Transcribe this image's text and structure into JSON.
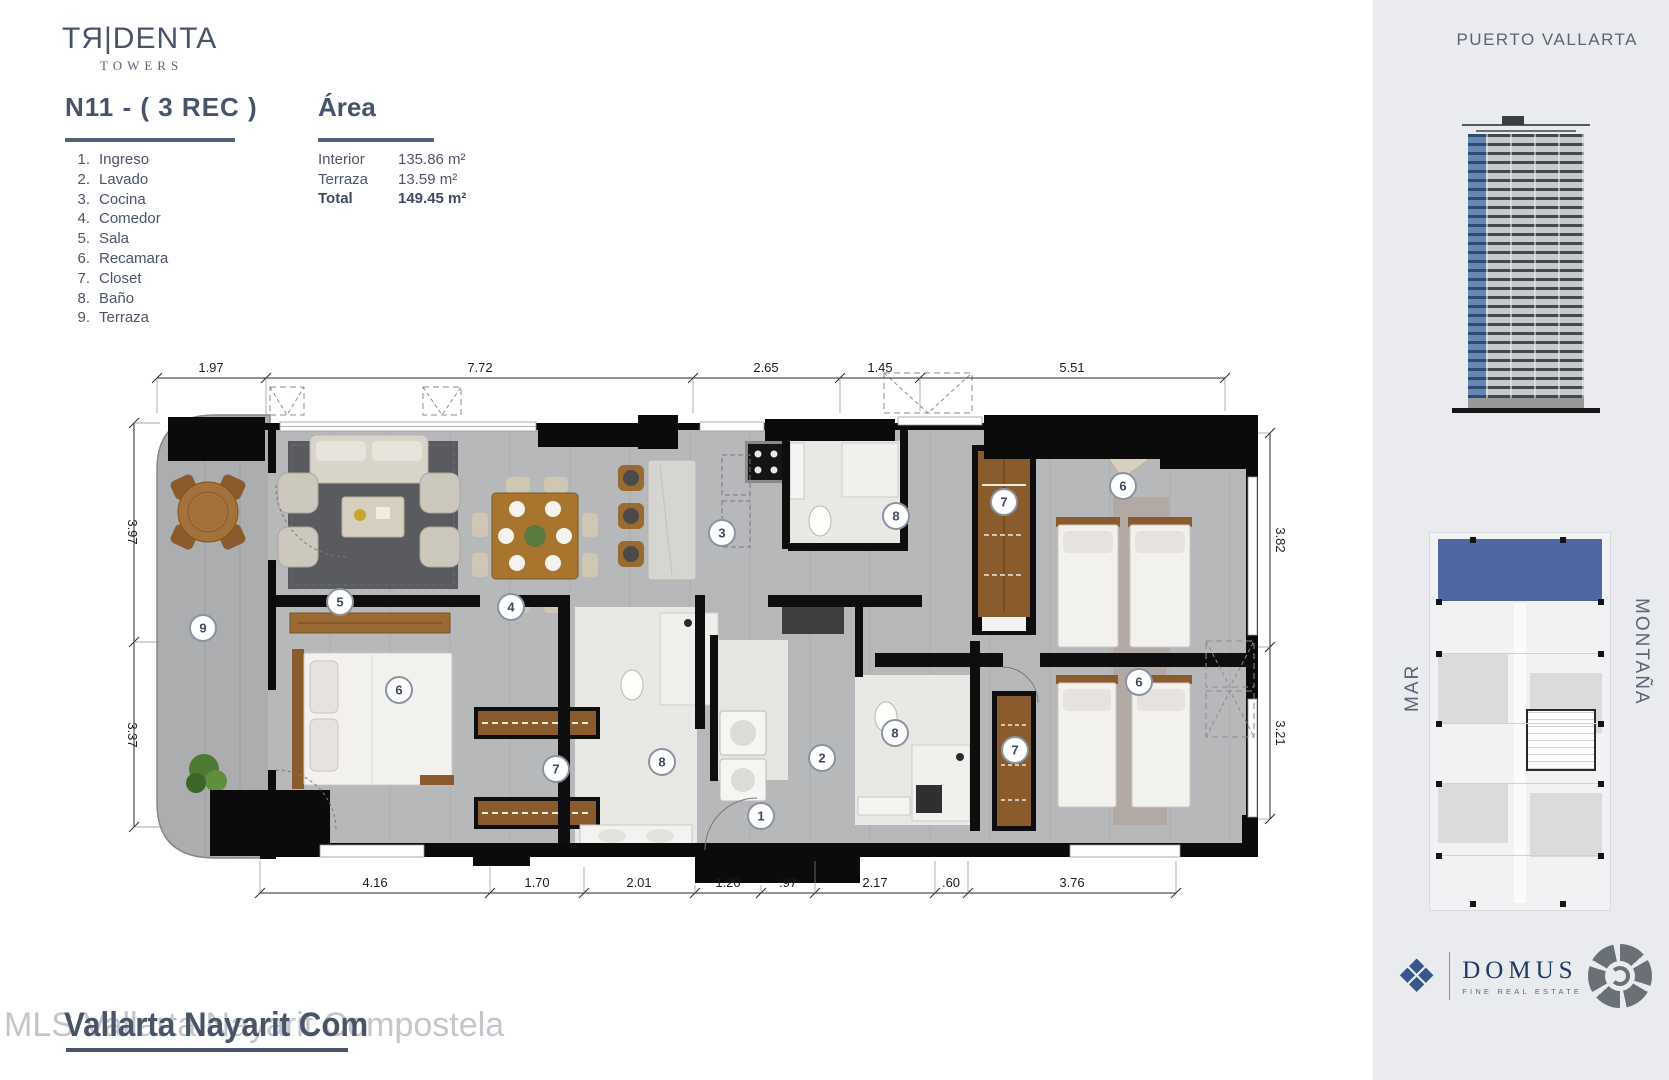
{
  "brand": {
    "name": "TЯ|DENTA",
    "sub": "TOWERS"
  },
  "sidebar": {
    "location": "PUERTO VALLARTA",
    "left_label": "MAR",
    "right_label": "MONTAÑA"
  },
  "unit": {
    "title": "N11 - ( 3 REC )"
  },
  "legend": {
    "items": [
      {
        "num": "1.",
        "label": "Ingreso"
      },
      {
        "num": "2.",
        "label": "Lavado"
      },
      {
        "num": "3.",
        "label": "Cocina"
      },
      {
        "num": "4.",
        "label": "Comedor"
      },
      {
        "num": "5.",
        "label": "Sala"
      },
      {
        "num": "6.",
        "label": "Recamara"
      },
      {
        "num": "7.",
        "label": "Closet"
      },
      {
        "num": "8.",
        "label": "Baño"
      },
      {
        "num": "9.",
        "label": "Terraza"
      }
    ]
  },
  "area": {
    "title": "Área",
    "rows": [
      {
        "label": "Interior",
        "value": "135.86 m²"
      },
      {
        "label": "Terraza",
        "value": "13.59 m²"
      },
      {
        "label": "Total",
        "value": "149.45 m²"
      }
    ]
  },
  "plan": {
    "dims_top": [
      "1.97",
      "7.72",
      "2.65",
      "1.45",
      "5.51"
    ],
    "dims_bottom": [
      "4.16",
      "1.70",
      "2.01",
      "1.20",
      ".97",
      "2.17",
      ".60",
      "3.76"
    ],
    "dims_left": [
      "3.97",
      "3.37"
    ],
    "dims_right": [
      "3.82",
      "3.21"
    ],
    "markers": [
      "1",
      "2",
      "3",
      "4",
      "5",
      "6",
      "6",
      "6",
      "7",
      "7",
      "7",
      "8",
      "8",
      "8",
      "9"
    ]
  },
  "footer": {
    "watermark_back": "MLS Vallarta Nayarit Compostela",
    "watermark_front": "Vallarta Nayarit Com",
    "brokerage": "DOMUS",
    "brokerage_tagline": "FINE REAL ESTATE"
  },
  "colors": {
    "accent_blue": "#4e69a2",
    "navy": "#1d3a66",
    "heading": "#47536a"
  }
}
